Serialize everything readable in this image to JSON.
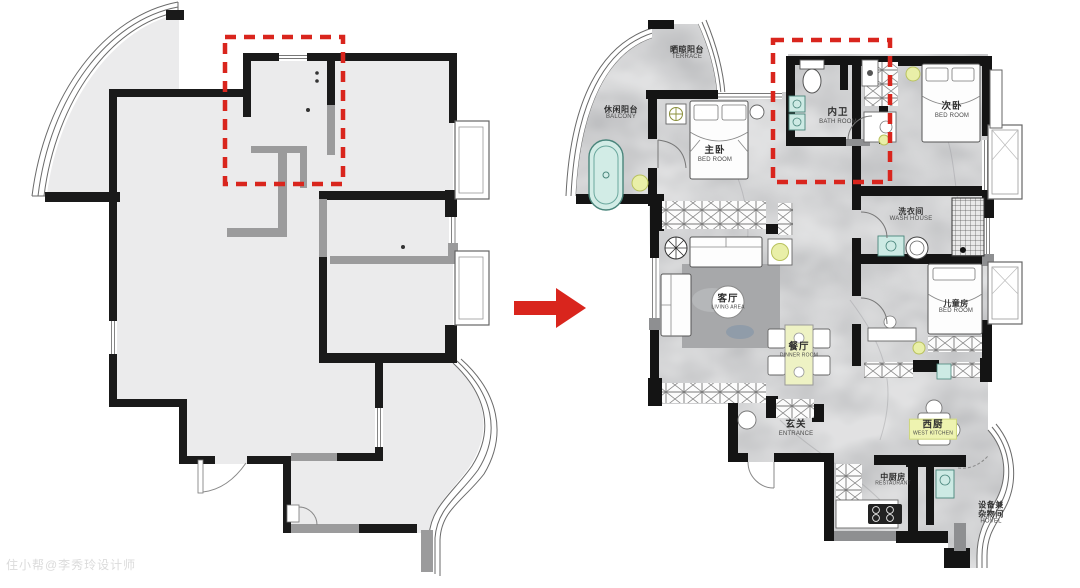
{
  "page": {
    "background": "#ffffff"
  },
  "watermark": {
    "text": "住小帮@李秀玲设计师"
  },
  "transform_arrow": {
    "direction": "right",
    "color": "#d9251d"
  },
  "annotation_boxes": [
    {
      "plan": "left",
      "style": "red-dashed"
    },
    {
      "plan": "right",
      "style": "red-dashed"
    }
  ],
  "colors": {
    "wall": "#1a1a1a",
    "left_floor": "#ebebec",
    "right_floor": "#bcbdbf",
    "accent_red": "#d9251d",
    "fixture_cyan": "#cdeae4",
    "light_yellow": "#e9efa8",
    "label_highlight": "#eef3b0"
  },
  "left_plan": {
    "labels": []
  },
  "right_plan": {
    "rooms": [
      {
        "id": "terrace",
        "zh": "晒晾阳台",
        "en": "TERRACE"
      },
      {
        "id": "leisure-balcony",
        "zh": "休闲阳台",
        "en": "BALCONY"
      },
      {
        "id": "master-bedroom",
        "zh": "主卧",
        "en": "BED ROOM"
      },
      {
        "id": "inner-bathroom",
        "zh": "内卫",
        "en": "BATH ROOM"
      },
      {
        "id": "second-bedroom",
        "zh": "次卧",
        "en": "BED ROOM"
      },
      {
        "id": "laundry",
        "zh": "洗衣间",
        "en": "WASH HOUSE"
      },
      {
        "id": "living",
        "zh": "客厅",
        "en": "LIVING AREA"
      },
      {
        "id": "dining",
        "zh": "餐厅",
        "en": "DINNER ROOM"
      },
      {
        "id": "kids-bedroom",
        "zh": "儿童房",
        "en": "BED ROOM"
      },
      {
        "id": "entrance",
        "zh": "玄关",
        "en": "ENTRANCE"
      },
      {
        "id": "west-kitchen",
        "zh": "西厨",
        "en": "WEST KITCHEN"
      },
      {
        "id": "chinese-kitchen",
        "zh": "中厨房",
        "en": "RESTAURANT"
      },
      {
        "id": "utility",
        "zh": "设备兼",
        "zh2": "杂物间",
        "en": "HOVEL"
      }
    ]
  }
}
